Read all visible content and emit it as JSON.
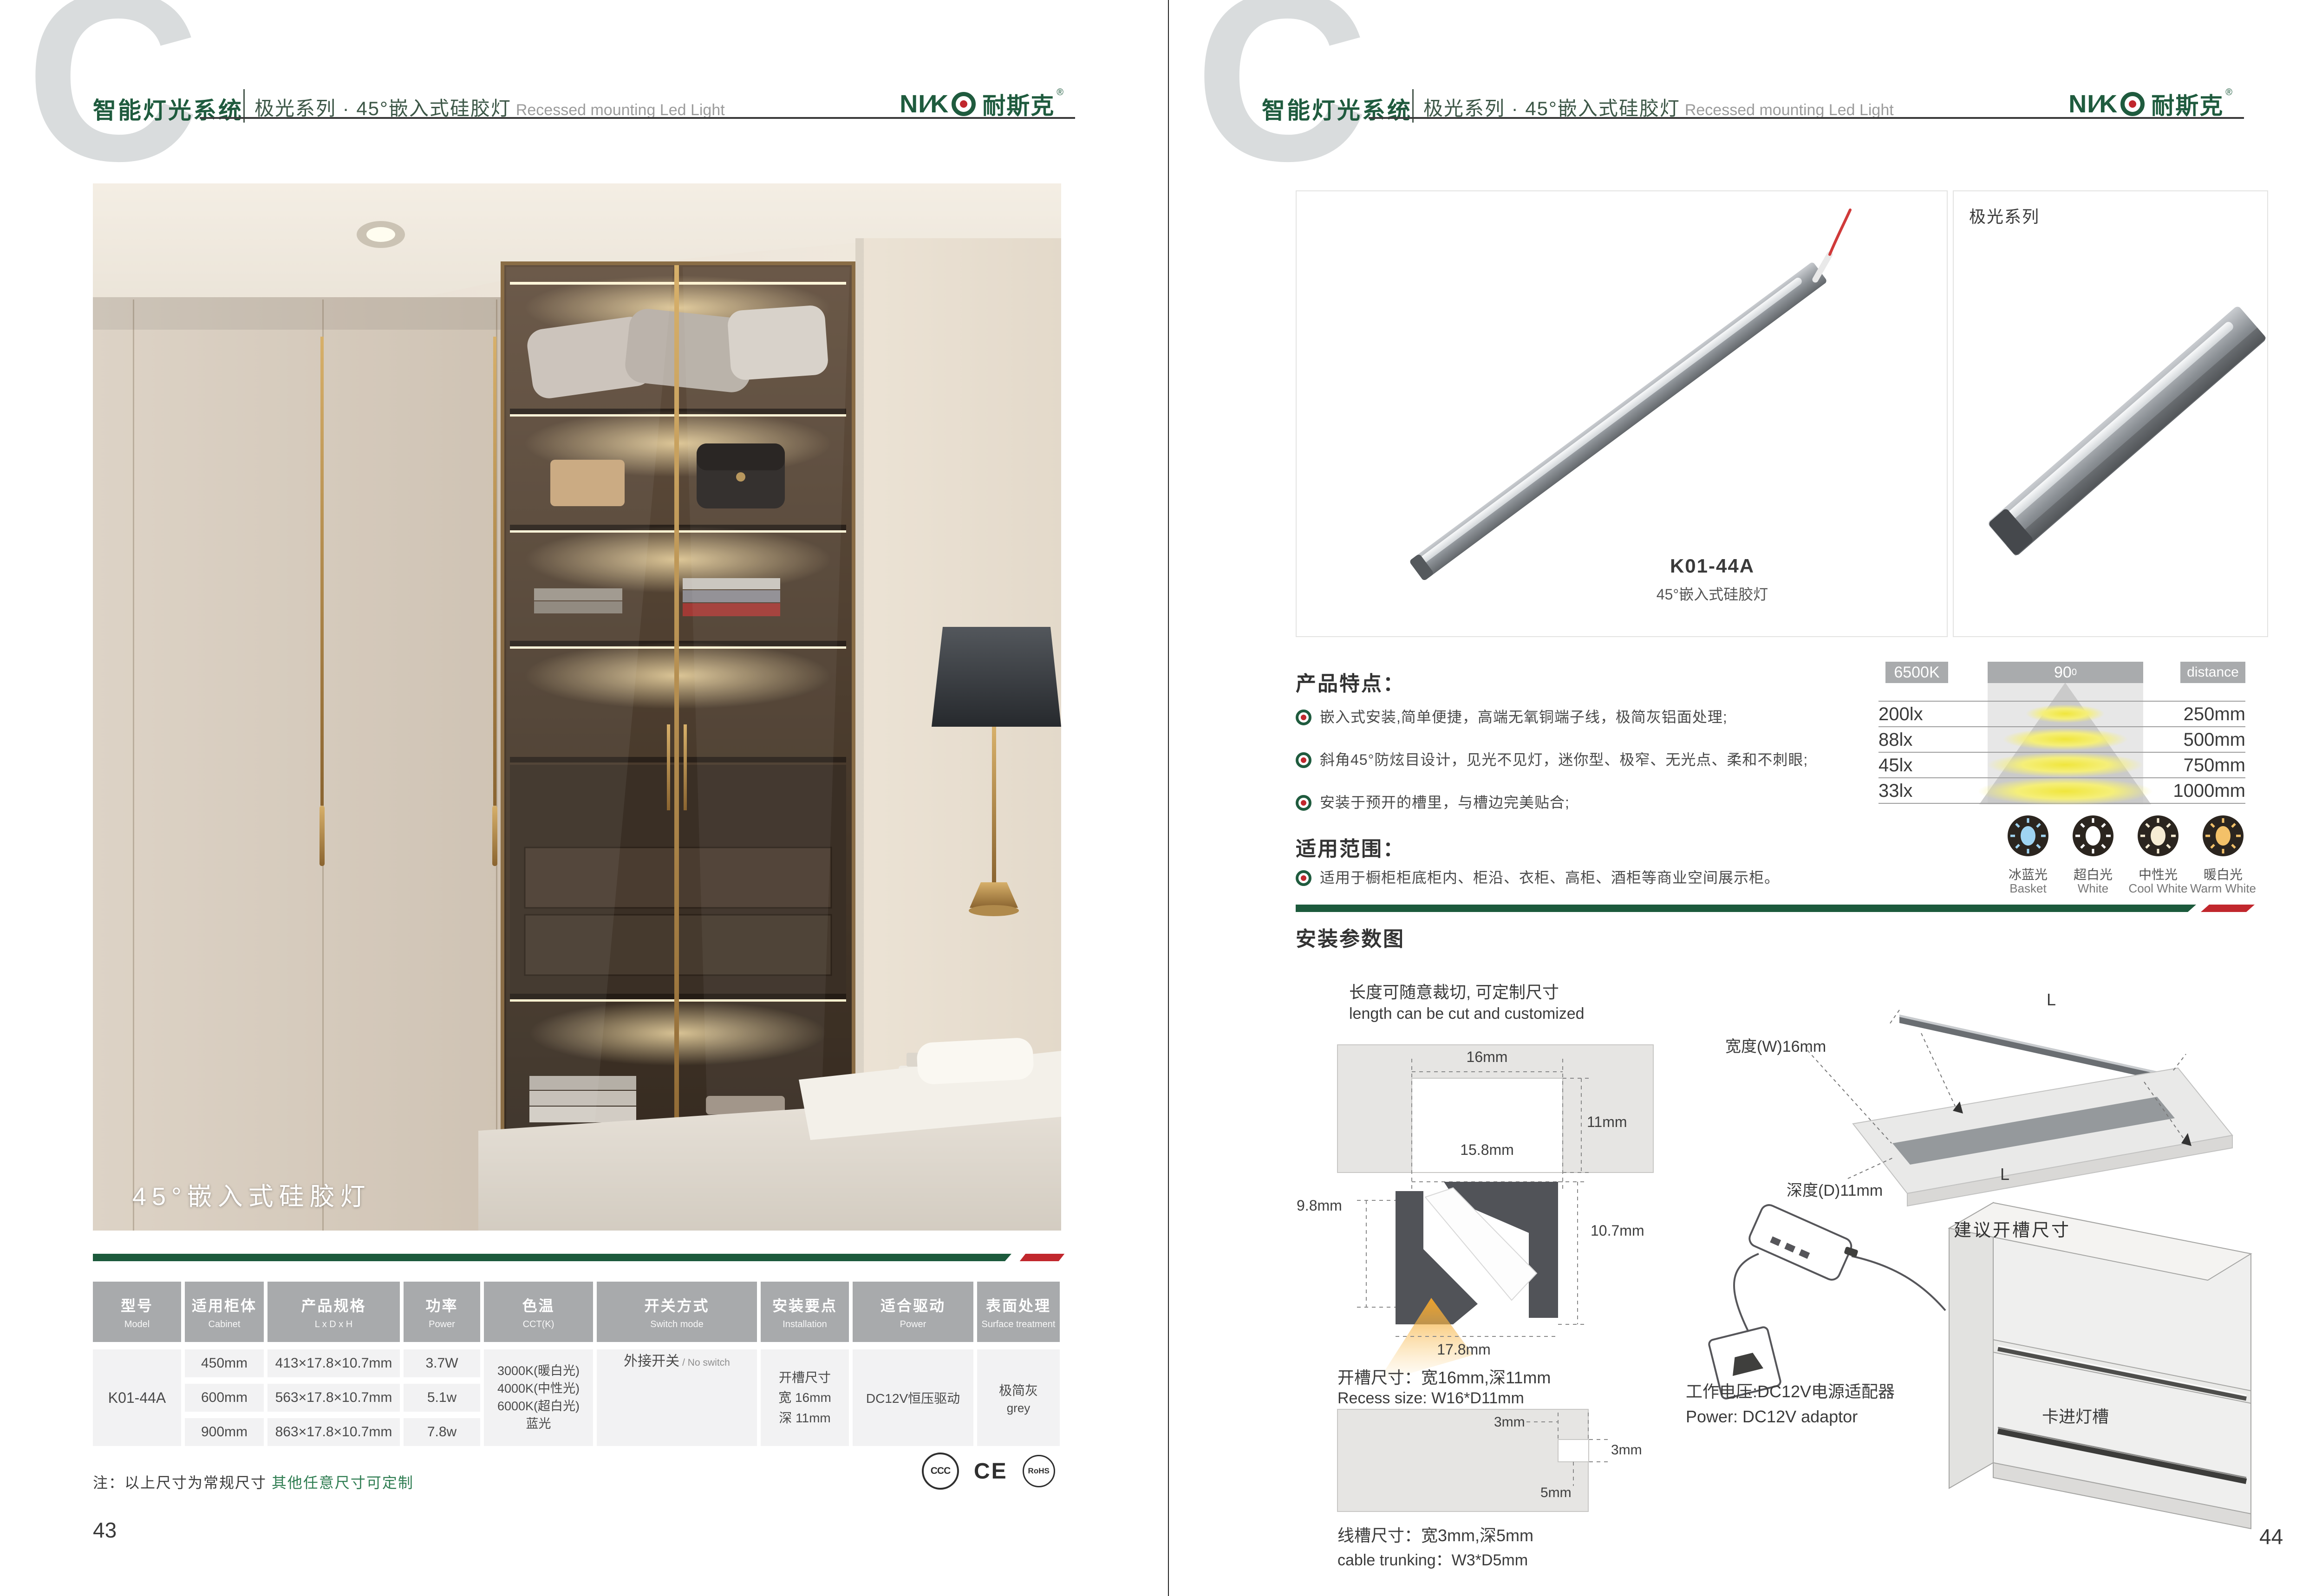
{
  "colors": {
    "brand_green": "#1f5b3e",
    "accent_red": "#c1272d",
    "note_green": "#2f7d52",
    "table_header_gray": "#a8aaac",
    "table_body_gray": "#f2f2f3"
  },
  "header": {
    "brand": "智能灯光系统",
    "series": "极光系列 · 45°嵌入式硅胶灯",
    "series_en": "Recessed mounting Led Light",
    "logo_latin": "NI∕K",
    "logo_cn": "耐斯克",
    "logo_reg": "®",
    "watermark": "C"
  },
  "left": {
    "photo_caption": "45°嵌入式硅胶灯",
    "table": {
      "headers": [
        {
          "zh": "型号",
          "en": "Model"
        },
        {
          "zh": "适用柜体",
          "en": "Cabinet"
        },
        {
          "zh": "产品规格",
          "en": "L x D x H"
        },
        {
          "zh": "功率",
          "en": "Power"
        },
        {
          "zh": "色温",
          "en": "CCT(K)"
        },
        {
          "zh": "开关方式",
          "en": "Switch mode"
        },
        {
          "zh": "安装要点",
          "en": "Installation"
        },
        {
          "zh": "适合驱动",
          "en": "Power"
        },
        {
          "zh": "表面处理",
          "en": "Surface treatment"
        }
      ],
      "model": "K01-44A",
      "rows": [
        {
          "cabinet": "450mm",
          "spec": "413×17.8×10.7mm",
          "power": "3.7W"
        },
        {
          "cabinet": "600mm",
          "spec": "563×17.8×10.7mm",
          "power": "5.1w"
        },
        {
          "cabinet": "900mm",
          "spec": "863×17.8×10.7mm",
          "power": "7.8w"
        }
      ],
      "cct": [
        "3000K(暖白光)",
        "4000K(中性光)",
        "6000K(超白光)",
        "蓝光"
      ],
      "switch_zh": "外接开关",
      "switch_en": "/ No switch",
      "install": [
        "开槽尺寸",
        "宽 16mm",
        "深 11mm"
      ],
      "driver": "DC12V恒压驱动",
      "surface_zh": "极简灰",
      "surface_en": "grey"
    },
    "note_black": "注：以上尺寸为常规尺寸",
    "note_green": "其他任意尺寸可定制",
    "certs": [
      "CCC",
      "CE",
      "RoHS"
    ],
    "page_no": "43"
  },
  "right": {
    "series_label": "极光系列",
    "model": "K01-44A",
    "model_sub": "45°嵌入式硅胶灯",
    "features_title": "产品特点：",
    "features": [
      "嵌入式安装,简单便捷，高端无氧铜端子线，极简灰铝面处理;",
      "斜角45°防炫目设计，见光不见灯，迷你型、极窄、无光点、柔和不刺眼;",
      "安装于预开的槽里，与槽边完美贴合;"
    ],
    "scope_title": "适用范围：",
    "scope": "适用于橱柜柜底柜内、柜沿、衣柜、高柜、酒柜等商业空间展示柜。",
    "beam": {
      "kelvin": "6500K",
      "angle": "90",
      "angle_sup": "0",
      "distance_label": "distance",
      "rows": [
        {
          "lux": "200lx",
          "mm": "250mm"
        },
        {
          "lux": "88lx",
          "mm": "500mm"
        },
        {
          "lux": "45lx",
          "mm": "750mm"
        },
        {
          "lux": "33lx",
          "mm": "1000mm"
        }
      ]
    },
    "ccts": [
      {
        "zh": "冰蓝光",
        "en": "Basket",
        "color": "#9fd4f2"
      },
      {
        "zh": "超白光",
        "en": "White",
        "color": "#ffffff"
      },
      {
        "zh": "中性光",
        "en": "Cool White",
        "color": "#f6ecd4"
      },
      {
        "zh": "暖白光",
        "en": "Warm White",
        "color": "#f3c169"
      }
    ],
    "install_title": "安装参数图",
    "cut_zh": "长度可随意裁切, 可定制尺寸",
    "cut_en": "length can be cut and customized",
    "dims": {
      "groove_w": "16mm",
      "groove_d": "11mm",
      "groove_bw": "15.8mm",
      "prof_l": "9.8mm",
      "prof_r": "10.7mm",
      "prof_b": "17.8mm",
      "notch_t": "3mm",
      "notch_w": "3mm",
      "notch_d": "5mm",
      "L1": "L",
      "L2": "L"
    },
    "recess_zh": "开槽尺寸：宽16mm,深11mm",
    "recess_en": "Recess size: W16*D11mm",
    "trunk_zh": "线槽尺寸：宽3mm,深5mm",
    "trunk_en": "cable trunking：W3*D5mm",
    "board_w": "宽度(W)16mm",
    "board_d": "深度(D)11mm",
    "board_caption": "建议开槽尺寸",
    "power_zh": "工作电压:DC12V电源适配器",
    "power_en": "Power: DC12V adaptor",
    "clip_label": "卡进灯槽",
    "page_no": "44"
  }
}
